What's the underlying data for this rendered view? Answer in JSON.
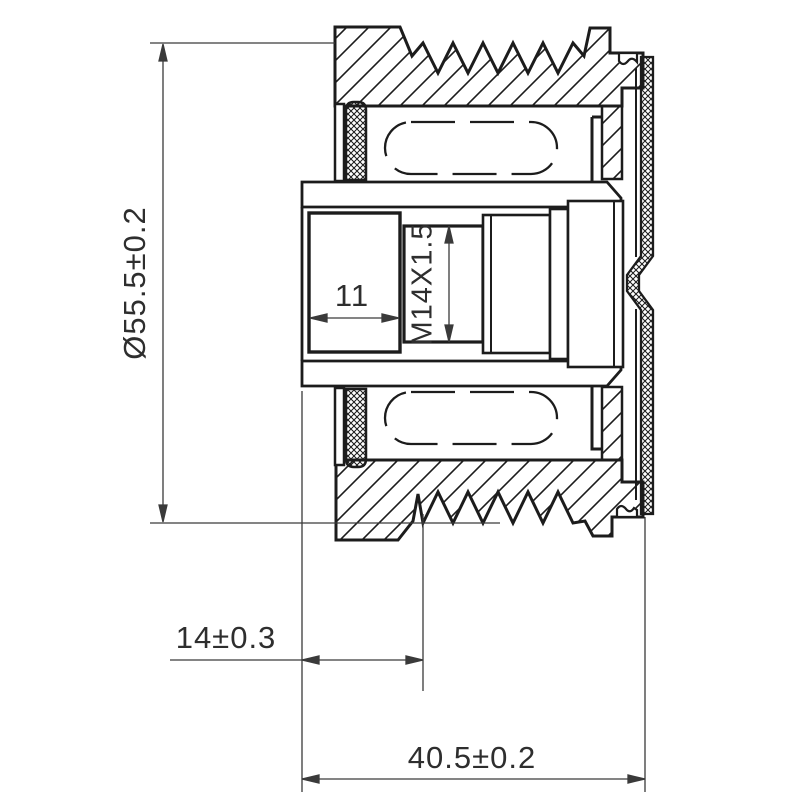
{
  "drawing": {
    "title": "pulley-cross-section",
    "colors": {
      "line": "#1c1c1c",
      "dimension": "#3a3a3a",
      "background": "#ffffff"
    },
    "dimensions": {
      "outer_diameter": "Ø55.5±0.2",
      "bore_depth": "11",
      "thread": "M14X1.5",
      "belt_offset": "14±0.3",
      "overall_width": "40.5±0.2"
    }
  }
}
